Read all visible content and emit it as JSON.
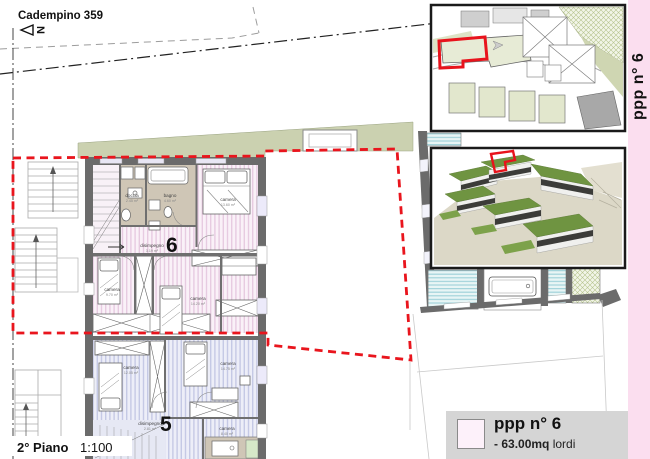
{
  "title": "Cadempino 359",
  "north_label": "N",
  "scale": {
    "floor": "2° Piano",
    "ratio": "1:100"
  },
  "strip": {
    "label": "ppp n° 6"
  },
  "legend": {
    "title": "ppp n° 6",
    "area_prefix": "-",
    "area_value": "63.00mq",
    "area_unit": "lordi"
  },
  "unit6": {
    "number": "6",
    "rooms": {
      "doccia": {
        "name": "doccia",
        "area": "2.45 m²"
      },
      "bagno": {
        "name": "bagno",
        "area": "4.60 m²"
      },
      "disimpegno": {
        "name": "disimpegno",
        "area": "3.19 m²"
      },
      "camera1": {
        "name": "camera",
        "area": "13.60 m²"
      },
      "camera2": {
        "name": "camera",
        "area": "9.70 m²"
      },
      "camera3": {
        "name": "camera",
        "area": "14.20 m²"
      }
    }
  },
  "unit5": {
    "number": "5",
    "rooms": {
      "disimpegno": {
        "name": "disimpegno",
        "area": "2.81 m²"
      },
      "camera1": {
        "name": "camera",
        "area": "12.05 m²"
      },
      "camera2": {
        "name": "camera",
        "area": "14.75 m²"
      },
      "camera3": {
        "name": "camera",
        "area": "8.40 m²"
      }
    }
  },
  "colors": {
    "boundary_red": "#e9151d",
    "unit6_hatch": "#e7cbe1",
    "unit5_hatch": "#c5c9e5",
    "strip_pink": "#fbdeef",
    "wall_gray": "#6b6b6b"
  }
}
